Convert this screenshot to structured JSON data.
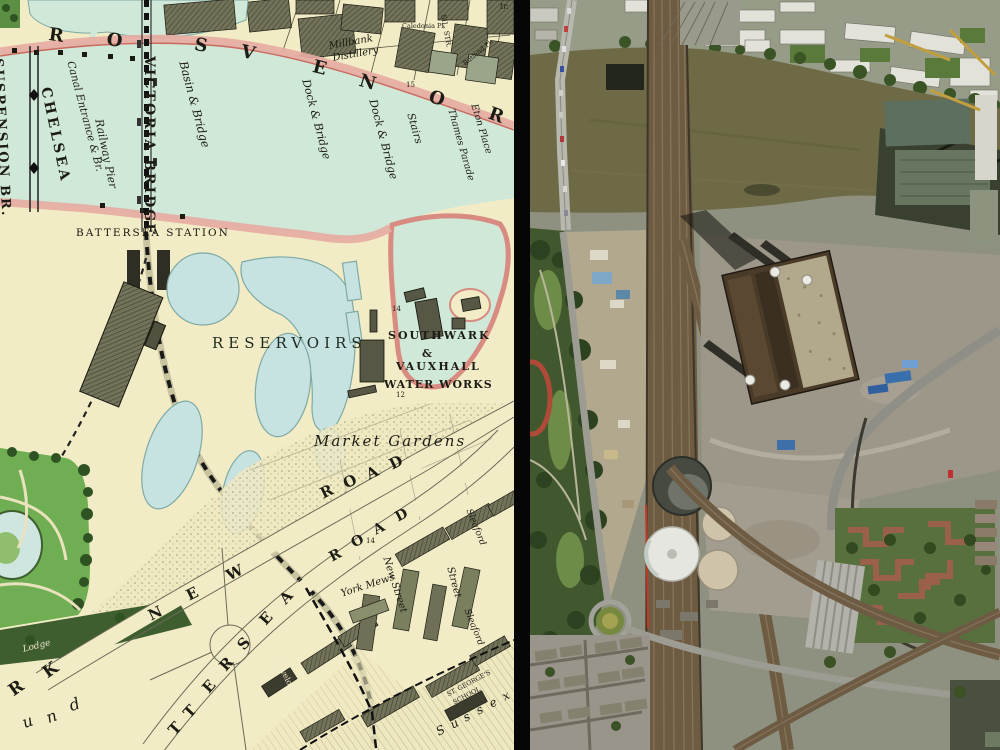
{
  "divider": {
    "color": "#060606"
  },
  "left_map": {
    "shore_letters": [
      "R",
      "O",
      "S",
      "V",
      "E",
      "N",
      "O",
      "R"
    ],
    "labels": {
      "suspension_bridge": "SUSPENSION BR.",
      "chelsea": "CHELSEA",
      "canal_entrance": "Canal Entrance & Br.",
      "railway_pier": "Railway Pier",
      "victoria_bridge": "VICTORIA BRIDGE",
      "basin_bridge": "Basin & Bridge",
      "millbank_1": "Millbank",
      "millbank_2": "Distillery",
      "dock_bridge_1": "Dock & Bridge",
      "dock_bridge_2": "Dock & Bridge",
      "stairs": "Stairs",
      "thames_parade": "Thames Parade",
      "eton_place": "Eton Place",
      "tr": "tr.",
      "sil_str": "SIL. STR.",
      "caledonia_pl": "Caledonia Pl.",
      "rutland_pl": "Rutland Pl.",
      "battersea_station": "BATTERSEA STATION",
      "reservoirs": "RESERVOIRS",
      "southwark": "SOUTHWARK",
      "ampersand": "&",
      "vauxhall": "VAUXHALL",
      "water_works": "WATER WORKS",
      "market_gardens": "Market Gardens",
      "york_mews": "York Mews",
      "new_street": "New Street",
      "street": "Street",
      "sleaford_1": "Sleaford",
      "sleaford_2": "Sleaford",
      "havelock_terrace": "Havelock T.",
      "st_georges": "ST. GEORGE'S",
      "school": "SCHOOL",
      "lodge": "Lodge",
      "num_15": "15",
      "num_14_a": "14",
      "num_12": "12",
      "num_14_b": "14"
    },
    "road_letters": {
      "new_road": [
        "N",
        "E",
        "W",
        "R",
        "O",
        "A",
        "D"
      ],
      "lower_road": [
        "R",
        "O",
        "A",
        "D"
      ],
      "battersea": [
        "T",
        "T",
        "E",
        "R",
        "S",
        "E",
        "A"
      ],
      "park": [
        "R",
        "K"
      ],
      "und": [
        "u",
        "n",
        "d"
      ],
      "sussex": [
        "S",
        "u",
        "s",
        "s",
        "e",
        "x"
      ]
    },
    "colors": {
      "paper": "#f2ecc6",
      "river": "#cfe8d8",
      "shore_pink": "#e7aba2",
      "park_green": "#6fae53",
      "reservoir_blue": "#c6e3e2",
      "building_olive": "#72735a"
    }
  },
  "right_aerial": {
    "features": [
      "thames-river",
      "grosvenor-railway-bridge",
      "chelsea-bridge",
      "battersea-power-station",
      "gas-holders",
      "battersea-park",
      "roundabout",
      "construction-site",
      "wasteland",
      "railway-viaducts",
      "housing-estate",
      "industrial-sheds"
    ],
    "colors": {
      "water": "#6d6a45",
      "tracks": "#6e5c42",
      "power_station": "#4a3b28",
      "chimney_white": "#ecebe3",
      "park": "#41582e",
      "wasteland": "#9d978a",
      "gas_holder": "#cfc4a9",
      "housing_brick": "#9a604b"
    }
  }
}
